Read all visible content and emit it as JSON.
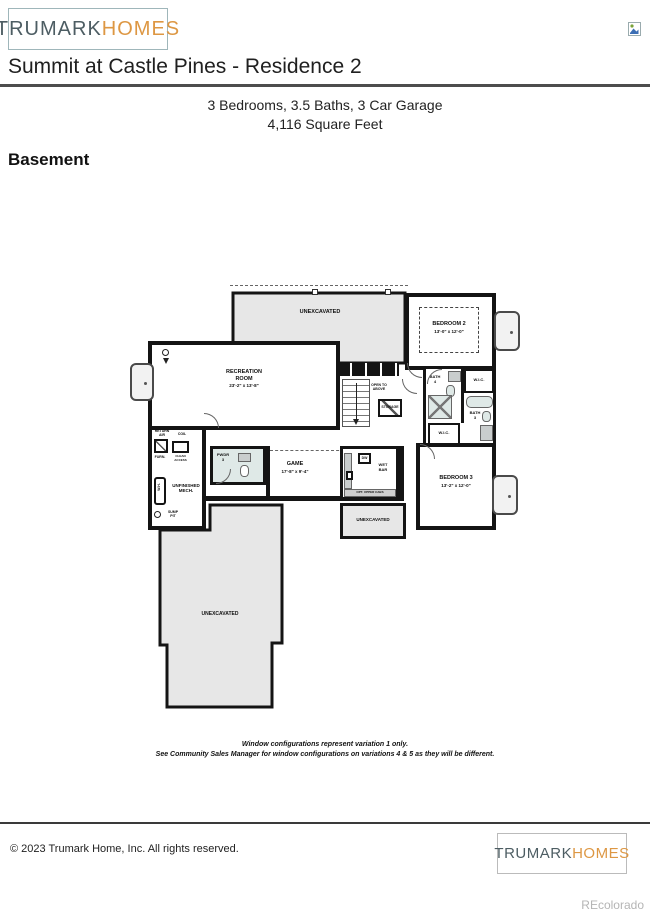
{
  "header": {
    "logo_part1": "TRUMARK",
    "logo_part2": "HOMES",
    "title": "Summit at Castle Pines - Residence 2",
    "subtitle1": "3 Bedrooms, 3.5 Baths, 3 Car Garage",
    "subtitle2": "4,116 Square Feet",
    "section": "Basement"
  },
  "plan": {
    "unexcavated_top": "UNEXCAVATED",
    "unexcavated_mid": "UNEXCAVATED",
    "unexcavated_bottom": "UNEXCAVATED",
    "recreation_name": "RECREATION\nROOM",
    "recreation_dims": "23'-2\" x 13'-8\"",
    "bedroom2_name": "BEDROOM 2",
    "bedroom2_dims": "13'-0\" x 12'-0\"",
    "bedroom3_name": "BEDROOM 3",
    "bedroom3_dims": "13'-2\" x 12'-0\"",
    "game_name": "GAME",
    "game_dims": "17'-8\" x 9'-4\"",
    "wet_bar": "WET\nBAR",
    "dw": "DW",
    "opt_cabs": "OPT. UPPER CABS",
    "bath3": "BATH\n3",
    "bath4": "BATH\n4",
    "wic_upper": "W.I.C.",
    "wic_lower": "W.I.C.",
    "pwdr": "PWDR\n3",
    "mech": "UNFINISHED\nMECH.",
    "storage": "STORAGE",
    "open_above": "OPEN TO\nABOVE",
    "return_air": "RETURN\nAIR",
    "furn": "FURN.",
    "coil": "COIL",
    "clean_access": "CLEAN\nACCESS",
    "water_heater": "W.H.",
    "sump": "SUMP\nPIT"
  },
  "disclaimer": {
    "line1": "Window configurations represent variation 1 only.",
    "line2": "See Community Sales Manager for window configurations on variations 4 & 5 as they will be different."
  },
  "footer": {
    "copyright": "© 2023 Trumark Home, Inc. All rights reserved.",
    "logo_part1": "TRUMARK",
    "logo_part2": "HOMES",
    "watermark": "REcolorado"
  },
  "colors": {
    "logo_gray": "#4d5d63",
    "logo_orange": "#dd9743",
    "wall": "#141414",
    "unexcavated_fill": "#e7e7e7",
    "bath_fixture_fill": "#dfe9e7",
    "title_rule": "#4d4d4d",
    "watermark": "#b5b5b5"
  }
}
